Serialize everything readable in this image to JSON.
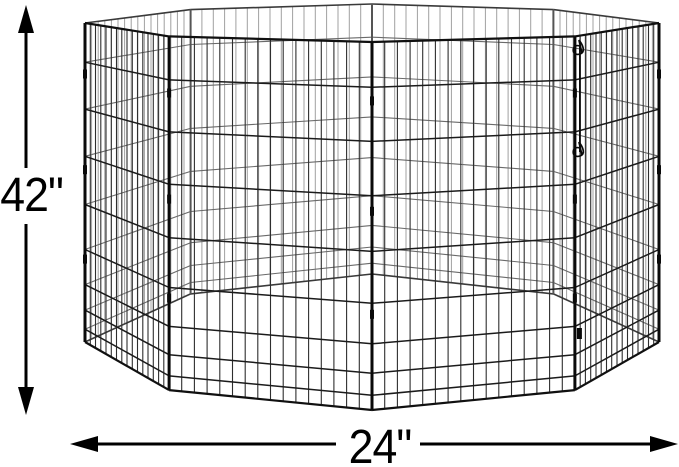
{
  "diagram": {
    "type": "product-dimension-diagram",
    "subject": "octagonal wire pet exercise pen",
    "background": "#ffffff"
  },
  "dimensions": {
    "height_label": "42\"",
    "width_label": "24\""
  },
  "pen": {
    "panel_count": 8,
    "vertical_wires_per_panel": 15,
    "horizontal_wire_fractions": [
      0,
      0.123,
      0.27,
      0.418,
      0.569,
      0.71,
      0.82,
      0.9,
      0.96,
      1
    ],
    "latch_count": 2
  },
  "figure": {
    "dimension_color": "#000000",
    "wire_front": "#2e2e2e",
    "wire_front_rail": "#101010",
    "wire_front_horizontal": "#1b1b1b",
    "post_front": "#0a0a0a",
    "wire_back": "#a0a0a0",
    "wire_back_horizontal": "#6a6a6a",
    "wire_back_rail": "#3a3a3a",
    "post_back": "#555555"
  }
}
